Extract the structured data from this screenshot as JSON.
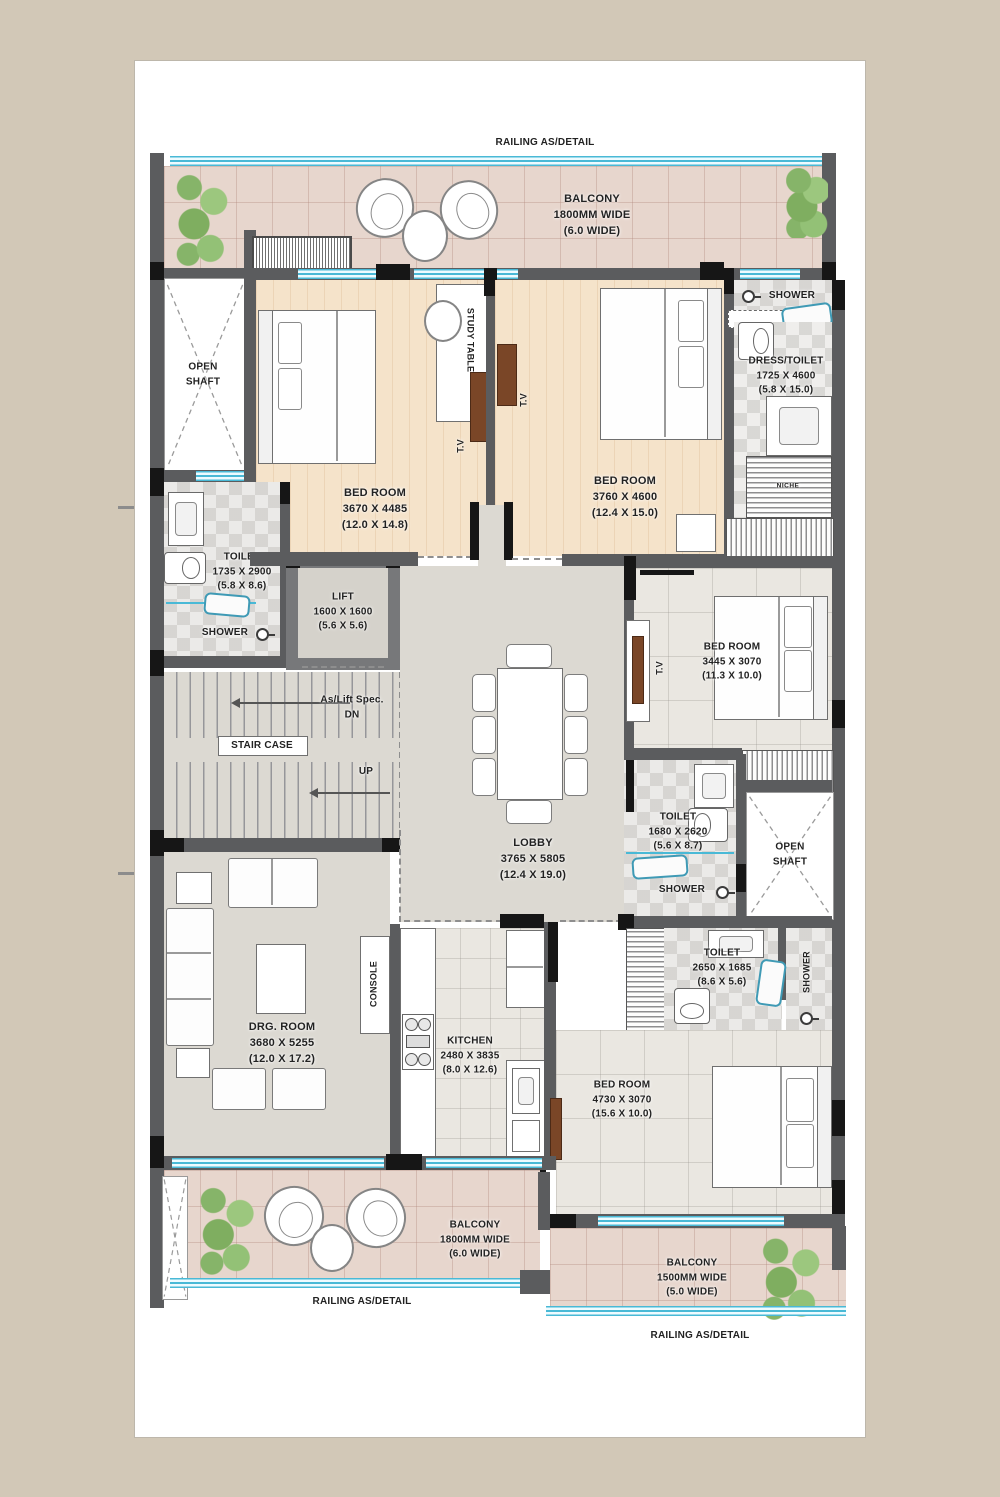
{
  "palette": {
    "canvas_bg": "#d2c8b7",
    "paper": "#ffffff",
    "wall_gray": "#5b5c5e",
    "wall_black": "#161616",
    "glass_cyan": "#49b9d6",
    "wood_floor": "#f5e3ca",
    "balcony_tile": "#e7d6cd",
    "gray_floor": "#dcd9d2",
    "plant_green": "#8cb96e",
    "tv_brown": "#7a4627"
  },
  "annotations": {
    "railing_top": "RAILING AS/DETAIL",
    "railing_bottom_left": "RAILING AS/DETAIL",
    "railing_bottom_right": "RAILING AS/DETAIL"
  },
  "rooms": {
    "balcony_top": {
      "name": "BALCONY",
      "size_mm": "1800MM WIDE",
      "size_ft": "(6.0 WIDE)"
    },
    "open_shaft_left": {
      "line1": "OPEN",
      "line2": "SHAFT"
    },
    "bedroom_1": {
      "name": "BED ROOM",
      "size_mm": "3670 X 4485",
      "size_ft": "(12.0 X 14.8)"
    },
    "bedroom_2": {
      "name": "BED ROOM",
      "size_mm": "3760 X 4600",
      "size_ft": "(12.4 X 15.0)"
    },
    "shower_top_right": {
      "name": "SHOWER"
    },
    "dress_toilet": {
      "name": "DRESS/TOILET",
      "size_mm": "1725 X 4600",
      "size_ft": "(5.8 X 15.0)"
    },
    "toilet_left": {
      "name": "TOILET",
      "size_mm": "1735 X 2900",
      "size_ft": "(5.8 X 8.6)"
    },
    "shower_left": {
      "name": "SHOWER"
    },
    "lift": {
      "name": "LIFT",
      "size_mm": "1600 X 1600",
      "size_ft": "(5.6 X 5.6)"
    },
    "lobby": {
      "name": "LOBBY",
      "size_mm": "3765 X 5805",
      "size_ft": "(12.4 X 19.0)"
    },
    "bedroom_3": {
      "name": "BED ROOM",
      "size_mm": "3445 X 3070",
      "size_ft": "(11.3 X 10.0)"
    },
    "toilet_mid": {
      "name": "TOILET",
      "size_mm": "1680 X 2620",
      "size_ft": "(5.6 X 8.7)"
    },
    "shower_mid": {
      "name": "SHOWER"
    },
    "open_shaft_right": {
      "line1": "OPEN",
      "line2": "SHAFT"
    },
    "toilet_bottom": {
      "name": "TOILET",
      "size_mm": "2650 X 1685",
      "size_ft": "(8.6 X 5.6)"
    },
    "shower_bottom_right": {
      "name": "SHOWER"
    },
    "drg_room": {
      "name": "DRG. ROOM",
      "size_mm": "3680 X 5255",
      "size_ft": "(12.0 X 17.2)"
    },
    "kitchen": {
      "name": "KITCHEN",
      "size_mm": "2480 X 3835",
      "size_ft": "(8.0 X 12.6)"
    },
    "bedroom_4": {
      "name": "BED ROOM",
      "size_mm": "4730 X 3070",
      "size_ft": "(15.6 X 10.0)"
    },
    "balcony_bottom_left": {
      "name": "BALCONY",
      "size_mm": "1800MM WIDE",
      "size_ft": "(6.0 WIDE)"
    },
    "balcony_bottom_right": {
      "name": "BALCONY",
      "size_mm": "1500MM WIDE",
      "size_ft": "(5.0 WIDE)"
    }
  },
  "stair": {
    "spec_line1": "As/Lift Spec.",
    "spec_line2": "DN",
    "label": "STAIR CASE",
    "up": "UP"
  },
  "fixtures": {
    "study_table": "STUDY TABLE",
    "tv": "T.V",
    "console": "CONSOLE",
    "niche": "NICHE"
  }
}
